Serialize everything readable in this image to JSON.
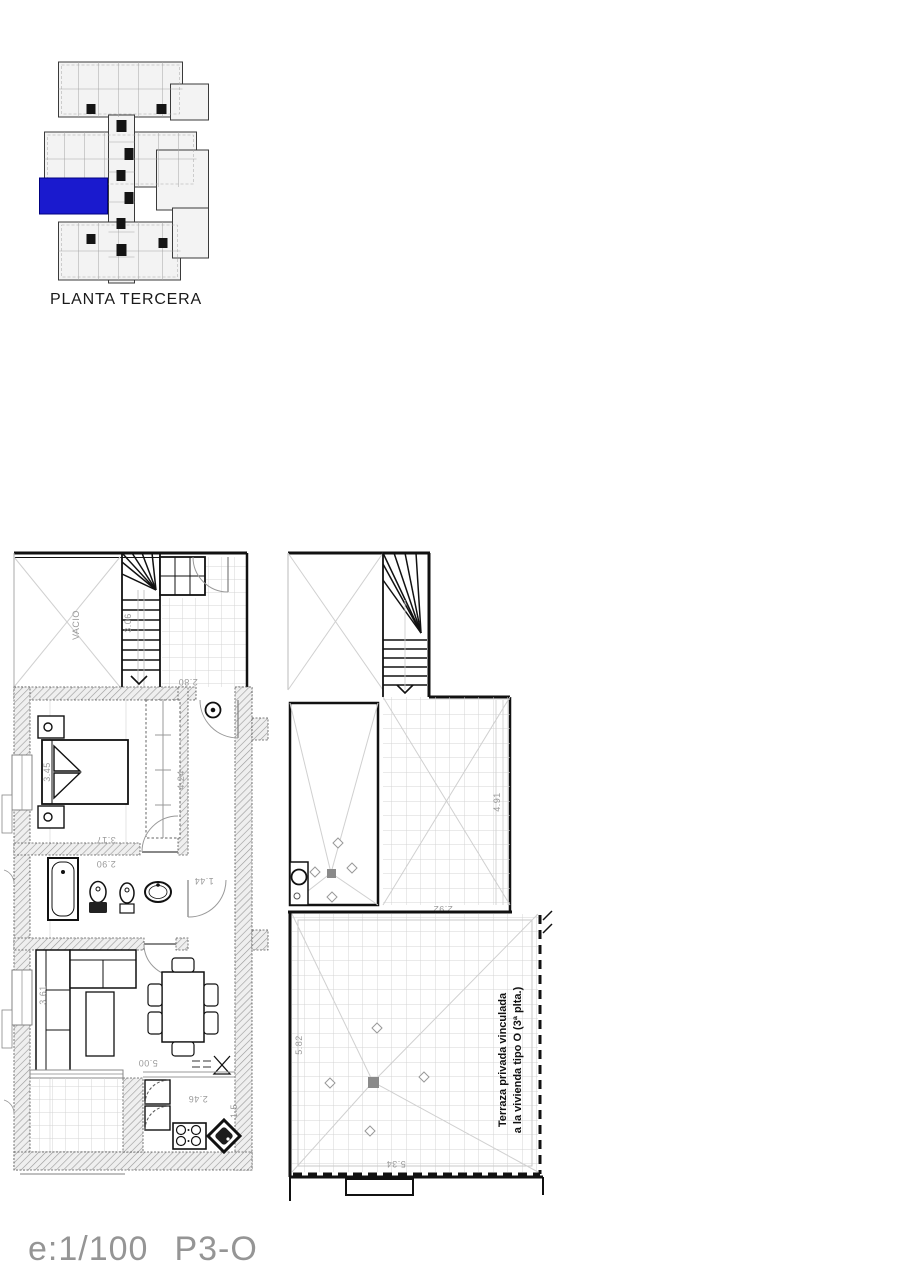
{
  "key_plan": {
    "title": "PLANTA TERCERA",
    "highlight_color": "#1a1ace"
  },
  "footer": {
    "scale": "e:1/100",
    "code": "P3-O"
  },
  "plan": {
    "labels": {
      "void": "VACIO",
      "terrace_note_1": "Terraza privada vinculada",
      "terrace_note_2": "a la vivienda tipo O (3ª plta.)"
    },
    "dimensions": {
      "stair": "3.06",
      "landing": "2.80",
      "bedroom_width": "3.45",
      "bedroom_length": "3.17",
      "wardrobe_side": "4.24",
      "bathroom_width": "2.90",
      "hall_width": "1.44",
      "living_length": "5.00",
      "living_width": "3.61",
      "kitchen_length": "2.46",
      "kitchen_width": "1.5",
      "upper_terrace_length": "4.91",
      "upper_terrace_width": "2.92",
      "terrace_width": "5.82",
      "terrace_length": "5.34"
    }
  }
}
